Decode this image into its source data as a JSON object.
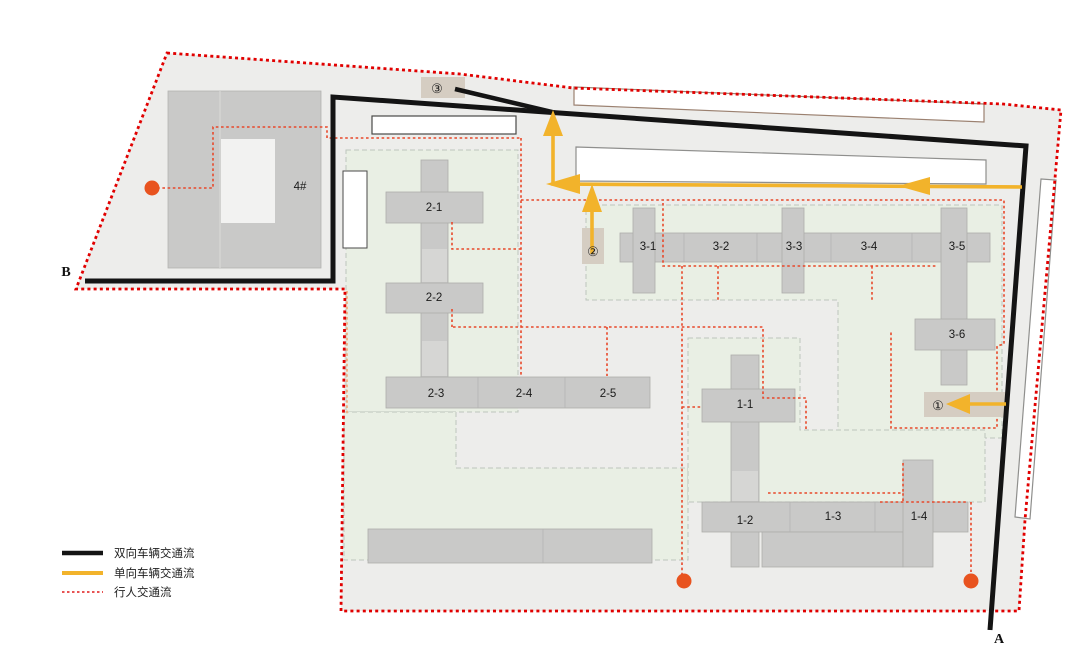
{
  "legend": {
    "items": [
      {
        "id": "two-way-vehicle",
        "label": "双向车辆交通流"
      },
      {
        "id": "one-way-vehicle",
        "label": "单向车辆交通流"
      },
      {
        "id": "pedestrian",
        "label": "行人交通流"
      }
    ]
  },
  "buildings": {
    "labels": {
      "b4": "4#",
      "b2_1": "2-1",
      "b2_2": "2-2",
      "b2_3": "2-3",
      "b2_4": "2-4",
      "b2_5": "2-5",
      "b3_1": "3-1",
      "b3_2": "3-2",
      "b3_3": "3-3",
      "b3_4": "3-4",
      "b3_5": "3-5",
      "b3_6": "3-6",
      "b1_1": "1-1",
      "b1_2": "1-2",
      "b1_3": "1-3",
      "b1_4": "1-4"
    }
  },
  "markers": {
    "exit_a": "A",
    "exit_b": "B",
    "gate_1": "①",
    "gate_2": "②",
    "gate_3": "③"
  },
  "colors": {
    "two_way_road": "#141414",
    "one_way_road": "#f2b32b",
    "pedestrian_path": "#e8482a",
    "site_boundary": "#e10000",
    "building_fill": "#c9c9c8",
    "landscape_fill": "#e9efe4",
    "site_fill": "#ededeb",
    "entrance_dot": "#e8531f",
    "gate_box_fill": "#d5cdc2"
  }
}
